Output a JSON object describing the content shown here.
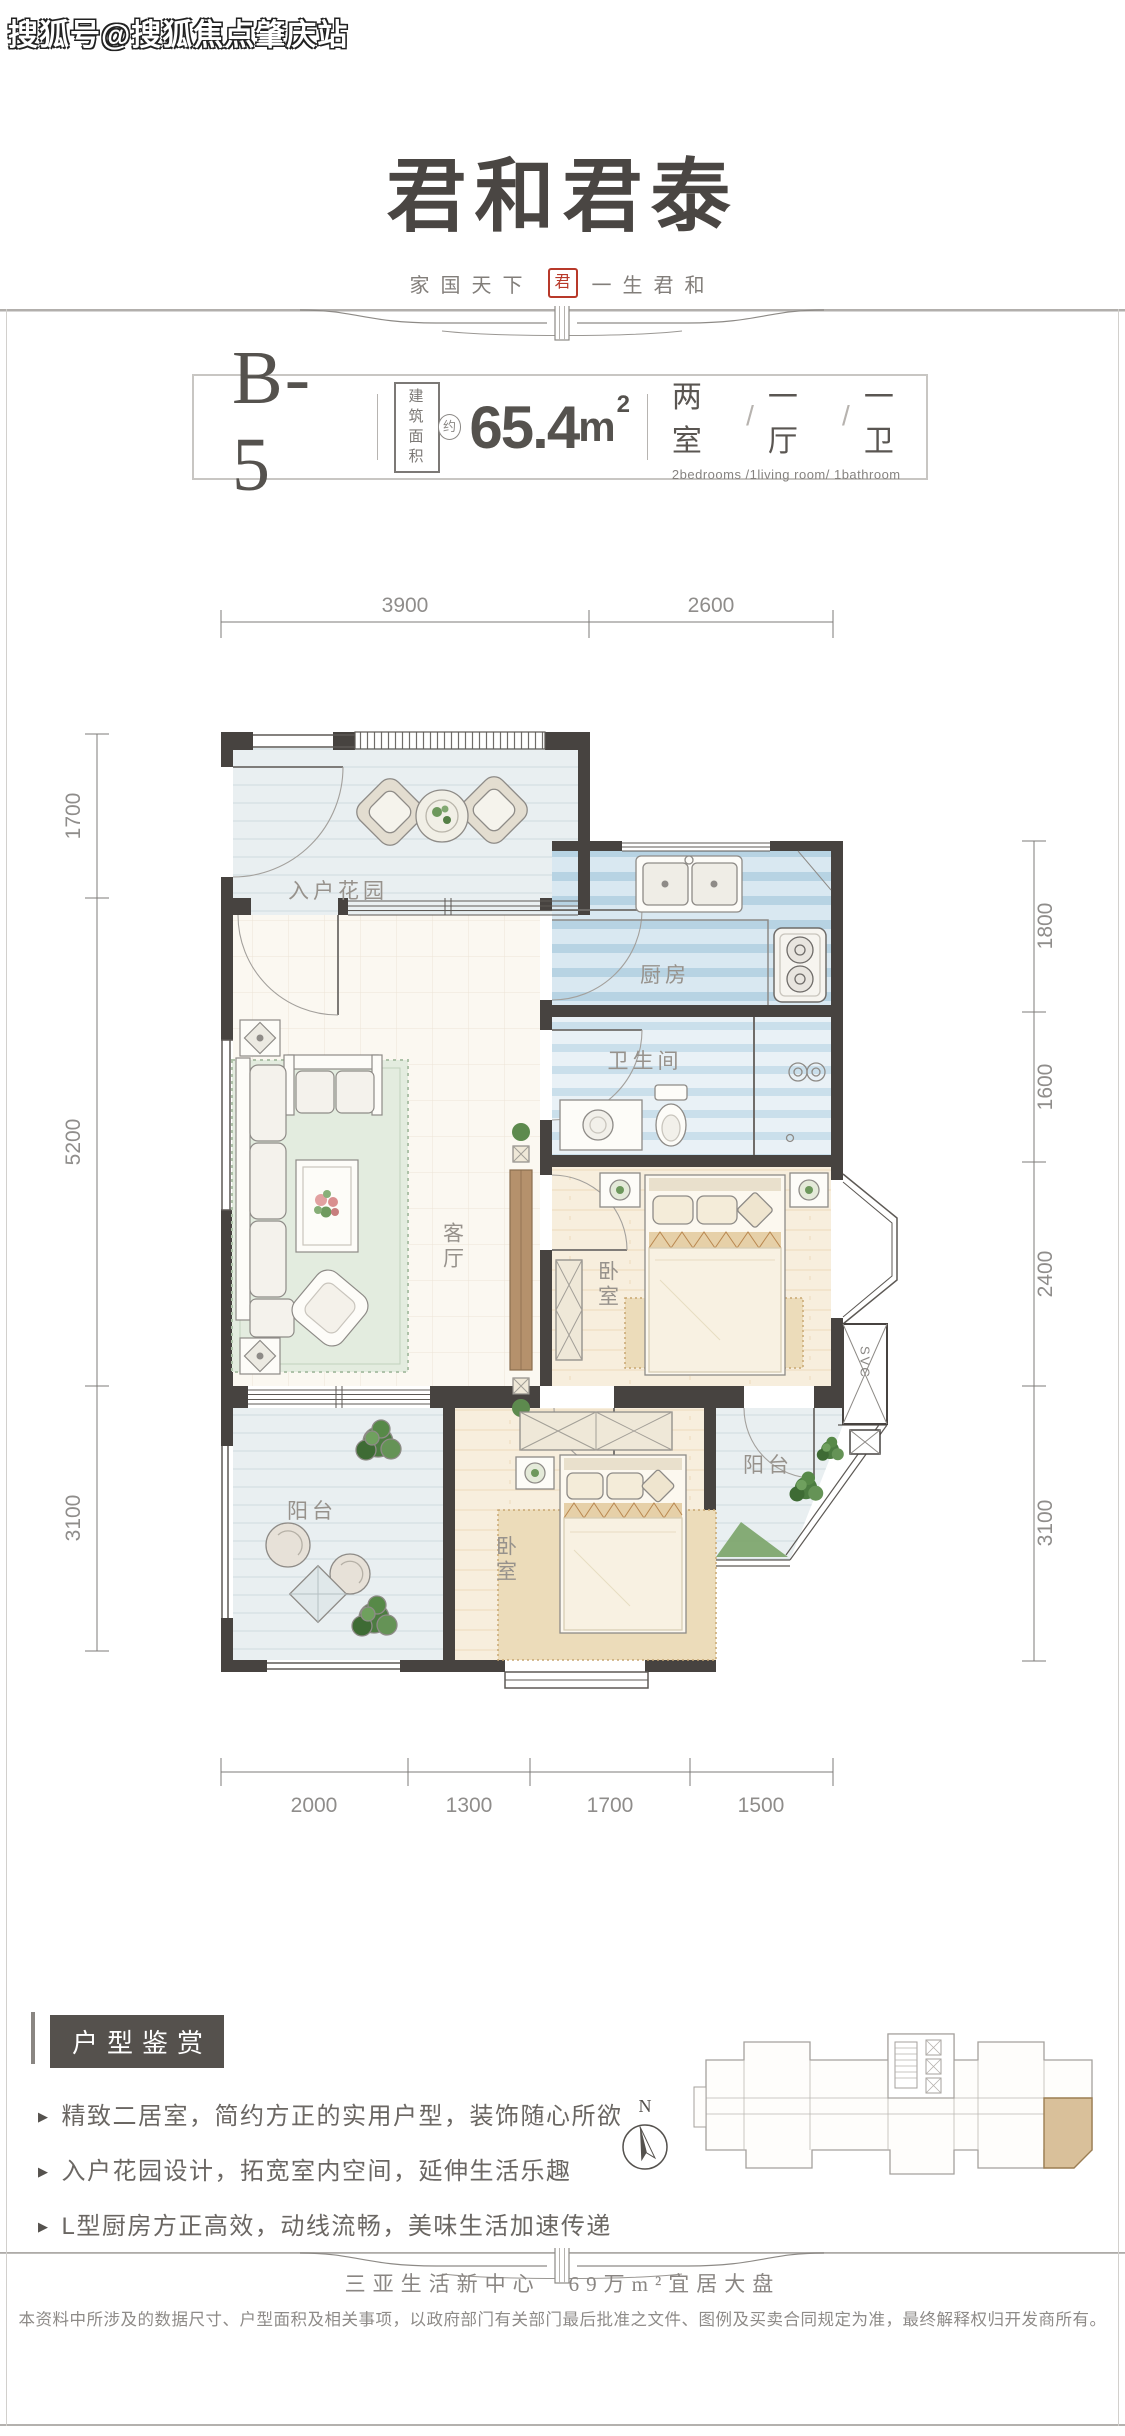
{
  "watermark": "搜狐号@搜狐焦点肇庆站",
  "brand": {
    "logo": "君和君泰",
    "tagline_left": "家国天下",
    "seal": "君",
    "tagline_right": "一生君和"
  },
  "unit": {
    "code": "B-5",
    "area_label": [
      "建筑",
      "面积"
    ],
    "area_approx": "约",
    "area_value": "65.4",
    "area_unit": "m",
    "area_sup": "2",
    "layout_parts": [
      "两室",
      "一厅",
      "一卫"
    ],
    "layout_sep": "/",
    "layout_en": "2bedrooms /1living room/ 1bathroom"
  },
  "plan": {
    "dims_top": [
      "3900",
      "2600"
    ],
    "dims_left": [
      "1700",
      "5200",
      "3100"
    ],
    "dims_right": [
      "1800",
      "1600",
      "2400",
      "3100"
    ],
    "dims_bottom": [
      "2000",
      "1300",
      "1700",
      "1500"
    ],
    "rooms": {
      "entry_garden": "入户花园",
      "kitchen": "厨房",
      "bathroom": "卫生间",
      "living": "客厅",
      "bedroom_master": "卧室",
      "bedroom_second": "卧室",
      "balcony_main": "阳台",
      "balcony_side": "阳台",
      "shaft": "SVC"
    }
  },
  "features": {
    "heading": "户型鉴赏",
    "marker": "▶",
    "bullets": [
      "精致二居室，简约方正的实用户型，装饰随心所欲",
      "入户花园设计，拓宽室内空间，延伸生活乐趣",
      "L型厨房方正高效，动线流畅，美味生活加速传递"
    ]
  },
  "compass": {
    "label": "N"
  },
  "footer": {
    "slogan": "三亚生活新中心　69万m²宜居大盘",
    "disclaimer": "本资料中所涉及的数据尺寸、户型面积及相关事项，以政府部门有关部门最后批准之文件、图例及买卖合同规定为准，最终解释权归开发商所有。"
  }
}
